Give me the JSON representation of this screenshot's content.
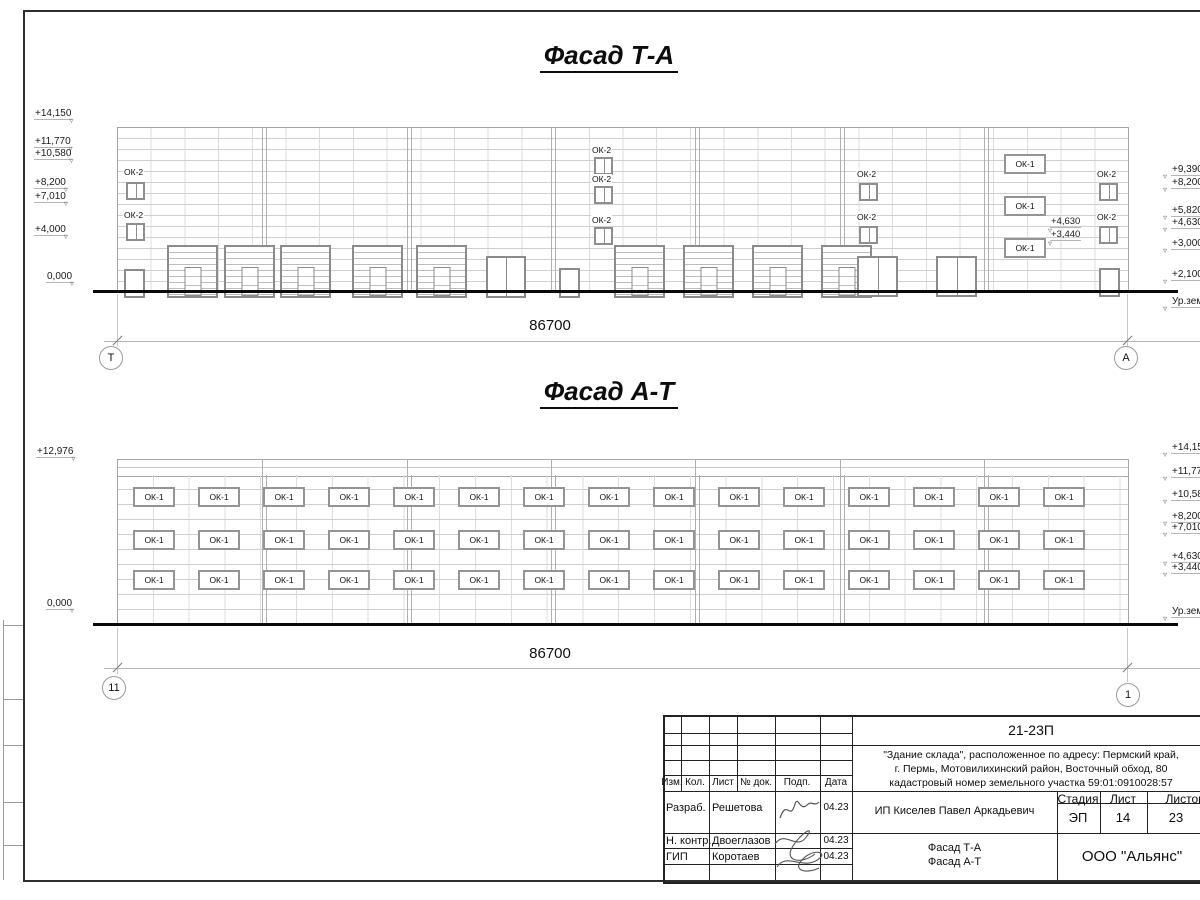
{
  "colors": {
    "ink": "#1a1a1a",
    "drawing_line": "#9a9a9a"
  },
  "labels": {
    "ok1": "ОК-1",
    "ok2": "ОК-2"
  },
  "facade1": {
    "title": "Фасад Т-А",
    "dimension": "86700",
    "grid_left": "Т",
    "grid_right": "А",
    "left_levels": [
      "+14,150",
      "+11,770",
      "+10,580",
      "+8,200",
      "+7,010",
      "+4,000",
      "0,000"
    ],
    "right_levels": [
      "+9,390",
      "+8,200",
      "+5,820",
      "+4,630",
      "+3,000",
      "+2,100",
      "Ур.земли"
    ],
    "annotations": [
      "+4,630",
      "+3,440"
    ]
  },
  "facade2": {
    "title": "Фасад А-Т",
    "dimension": "86700",
    "grid_left": "11",
    "grid_right": "1",
    "left_levels": [
      "+12,976",
      "0,000"
    ],
    "right_levels": [
      "+14,150",
      "+11,770",
      "+10,580",
      "+8,200",
      "+7,010",
      "+4,630",
      "+3,440",
      "Ур.земли"
    ]
  },
  "titleblock": {
    "code": "21-23П",
    "description": "\"Здание склада\", расположенное по адресу: Пермский край,\nг. Пермь, Мотовилихинский район, Восточный обход, 80\nкадастровый номер земельного участка 59:01:0910028:57",
    "columns": [
      "Изм.",
      "Кол.",
      "Лист",
      "№ док.",
      "Подп.",
      "Дата"
    ],
    "rows": [
      {
        "role": "Разраб.",
        "name": "Решетова",
        "date": "04.23"
      },
      {
        "role": "Н. контр.",
        "name": "Двоеглазов",
        "date": "04.23"
      },
      {
        "role": "ГИП",
        "name": "Коротаев",
        "date": "04.23"
      }
    ],
    "client": "ИП Киселев Павел Аркадьевич",
    "stage_columns": [
      "Стадия",
      "Лист",
      "Листов"
    ],
    "stage_values": [
      "ЭП",
      "14",
      "23"
    ],
    "sheet_title": "Фасад Т-А\nФасад А-Т",
    "org": "ООО \"Альянс\""
  }
}
